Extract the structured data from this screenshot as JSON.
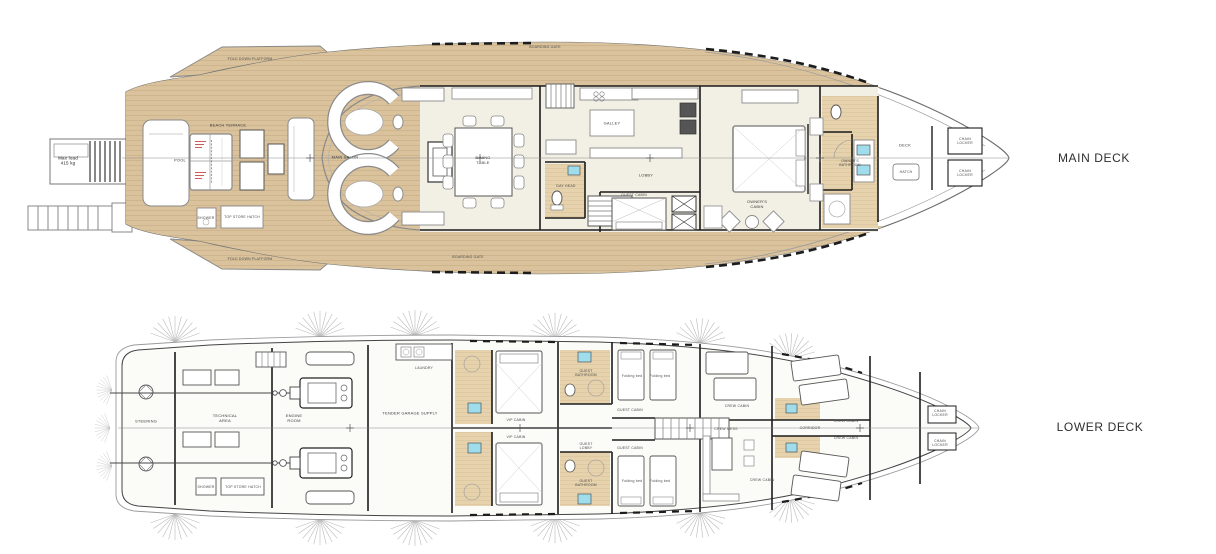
{
  "document": {
    "type": "yacht-general-arrangement-plan",
    "deck_count": 2
  },
  "colors": {
    "teak": "#d9c29c",
    "teak_line": "#c3a87e",
    "bath_teak": "#e6d2ac",
    "bath_teak_line": "#d2bb90",
    "interior": "#f2efe4",
    "wall": "#1c1c1c",
    "hull_line": "#6f6f6f",
    "furniture_line": "#8a8a8a",
    "sink_cyan": "#9fdcec",
    "red_annotation": "#c23333",
    "title_text": "#2e2e2e"
  },
  "main_deck": {
    "title": "MAIN DECK",
    "labels": {
      "fold_platform_top": "FOLD DOWN PLATFORM",
      "fold_platform_bottom": "FOLD DOWN PLATFORM",
      "boarding_gate_top": "BOARDING GATE",
      "boarding_gate_bottom": "BOARDING GATE",
      "beach_terrace": "BEACH TERRACE",
      "pool": "POOL",
      "max_load": "Max load\n415 kg",
      "shower": "SHOWER",
      "top_store_hatch": "TOP STORE HATCH",
      "main_salon": "MAIN SALON",
      "dining_table": "DINING\nTABLE",
      "galley": "GALLEY",
      "day_head": "DAY HEAD",
      "lobby": "LOBBY",
      "guest_cabin": "GUEST CABIN",
      "owners_cabin": "OWNER'S\nCABIN",
      "owners_bathroom": "OWNER'S\nBATHROOM",
      "deck": "DECK",
      "hatch": "HATCH",
      "chain_locker_port": "CHAIN\nLOCKER",
      "chain_locker_starboard": "CHAIN\nLOCKER"
    }
  },
  "lower_deck": {
    "title": "LOWER DECK",
    "labels": {
      "steering": "STEERING",
      "technical_area": "TECHNICAL\nAREA",
      "engine_room": "ENGINE\nROOM",
      "shower": "SHOWER",
      "top_store_hatch": "TOP STORE HATCH",
      "laundry": "LAUNDRY",
      "tender_garage": "TENDER GARAGE SUPPLY",
      "vip_cabin_port": "VIP CABIN",
      "vip_cabin_starboard": "VIP CABIN",
      "guest_bathroom_port": "GUEST\nBATHROOM",
      "guest_bathroom_starboard": "GUEST\nBATHROOM",
      "guest_lobby": "GUEST\nLOBBY",
      "guest_cabin_port": "GUEST CABIN",
      "guest_cabin_starboard": "GUEST CABIN",
      "folding_bed": "Folding bed",
      "crew_mess": "CREW MESS",
      "crew_cabin_aft": "CREW CABIN",
      "crew_cabin_aft_starboard": "CREW CABIN",
      "crew_cabin_fwd_port": "CREW CABIN",
      "crew_cabin_fwd_starboard": "CREW CABIN",
      "corridor": "CORRIDOR",
      "chain_locker_port": "CHAIN\nLOCKER",
      "chain_locker_starboard": "CHAIN\nLOCKER"
    }
  }
}
